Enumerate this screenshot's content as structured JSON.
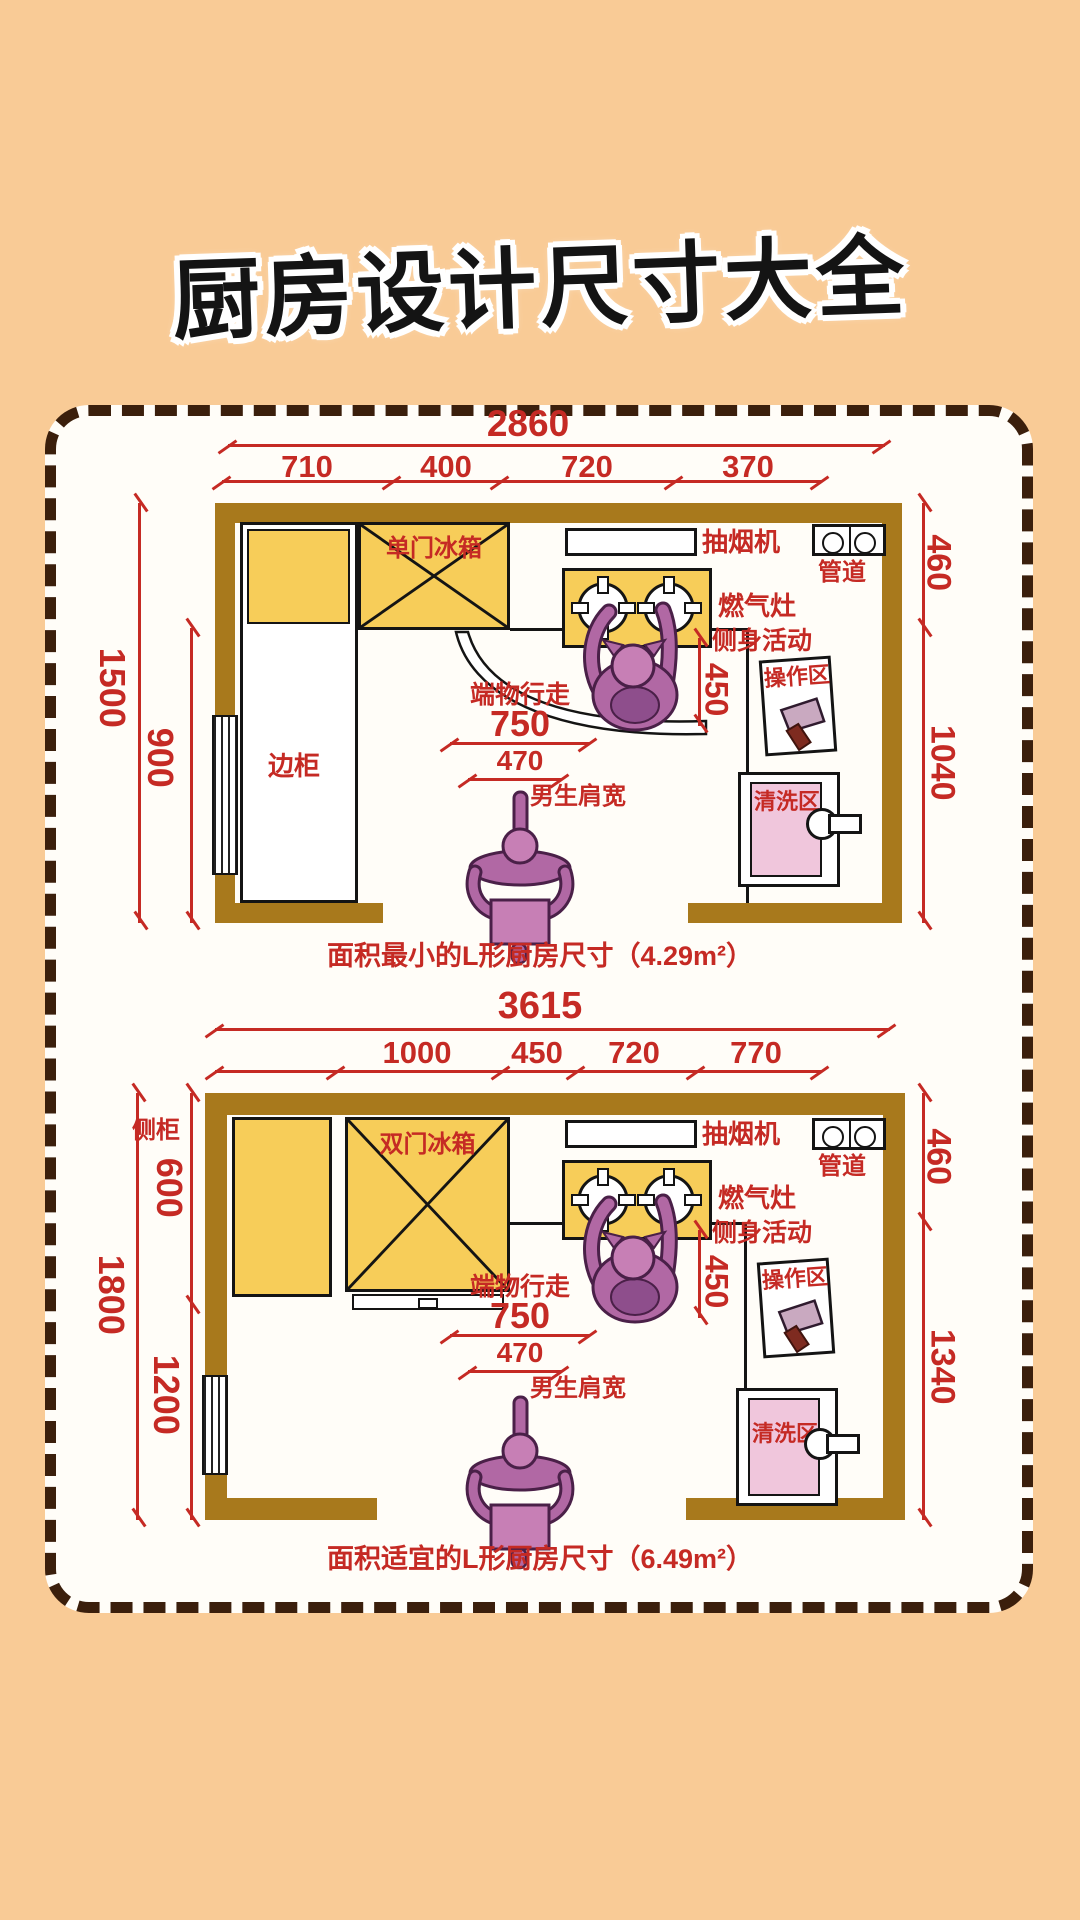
{
  "title": "厨房设计尺寸大全",
  "colors": {
    "background": "#f9cb96",
    "accent_red": "#c52a24",
    "wall_brown": "#a8791c",
    "cabinet_yellow": "#f7cd59",
    "sink_pink": "#f0c6dc",
    "person_purple": "#b168a4",
    "dash_brown": "#3b1f0c"
  },
  "plan1": {
    "total": "2860",
    "segs": [
      "710",
      "400",
      "720",
      "370"
    ],
    "left_total": "1500",
    "left_lower": "900",
    "right_top": "460",
    "right_bottom": "1040",
    "fridge": "单门冰箱",
    "side_cabinet": "边柜",
    "hood": "抽烟机",
    "pipe": "管道",
    "stove": "燃气灶",
    "side_activity": "侧身活动",
    "activity_dim": "450",
    "carry_walk": "端物行走",
    "carry_dim": "750",
    "shoulder_dim": "470",
    "shoulder": "男生肩宽",
    "op_zone": "操作区",
    "wash_zone": "清洗区",
    "caption": "面积最小的L形厨房尺寸（4.29m²）"
  },
  "plan2": {
    "total": "3615",
    "segs": [
      "1000",
      "450",
      "720",
      "770"
    ],
    "left_total": "1800",
    "left_upper": "600",
    "left_lower": "1200",
    "right_top": "460",
    "right_bottom": "1340",
    "fridge": "双门冰箱",
    "side_cabinet": "侧柜",
    "hood": "抽烟机",
    "pipe": "管道",
    "stove": "燃气灶",
    "side_activity": "侧身活动",
    "activity_dim": "450",
    "carry_walk": "端物行走",
    "carry_dim": "750",
    "shoulder_dim": "470",
    "shoulder": "男生肩宽",
    "op_zone": "操作区",
    "wash_zone": "清洗区",
    "caption": "面积适宜的L形厨房尺寸（6.49m²）"
  }
}
